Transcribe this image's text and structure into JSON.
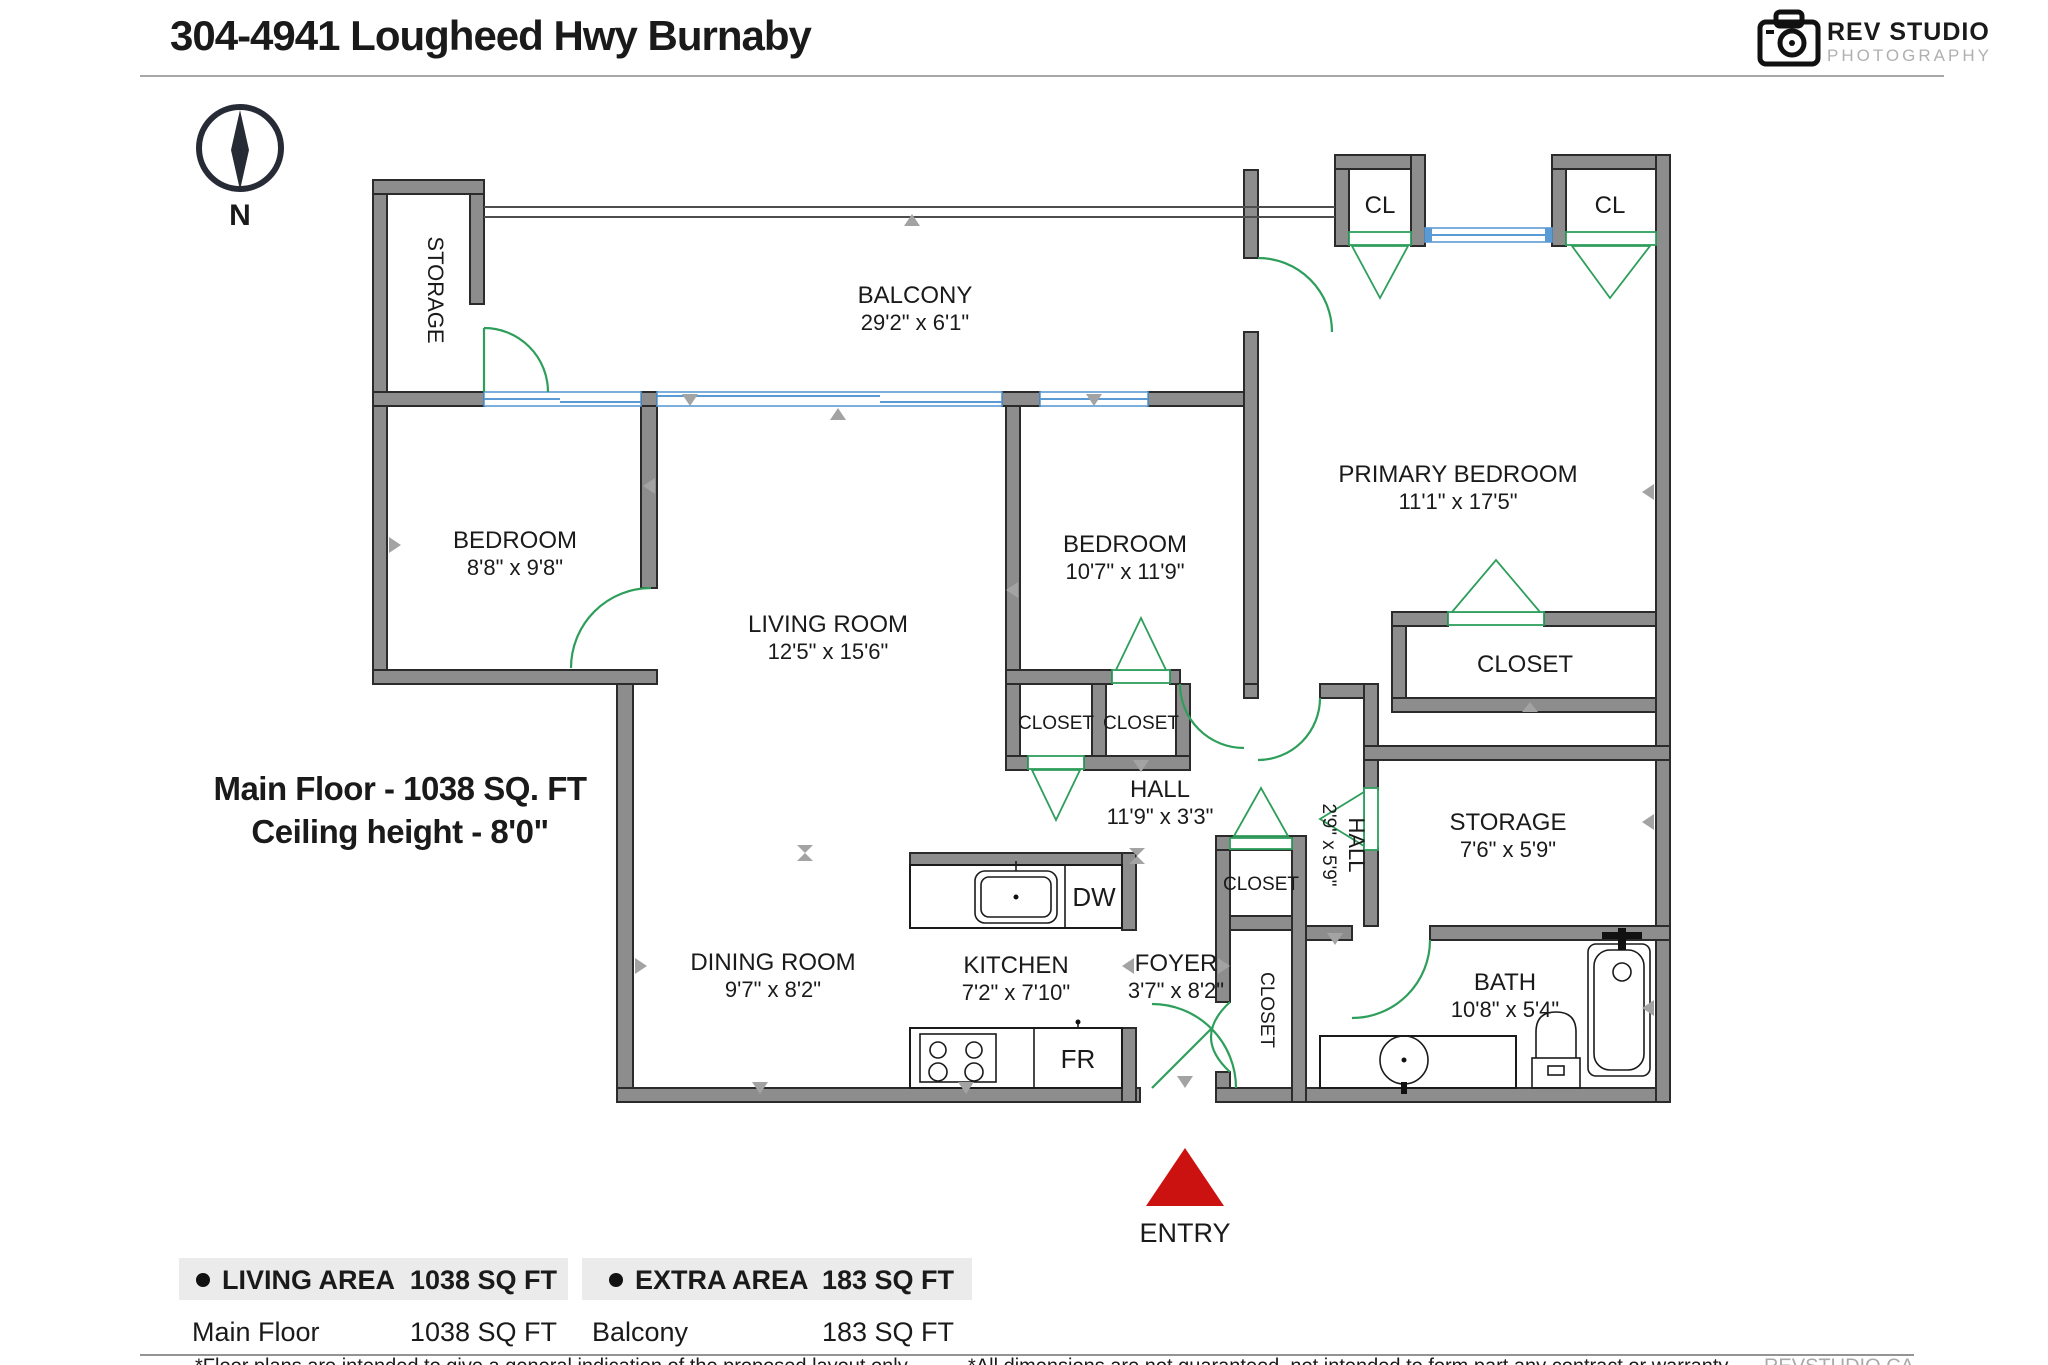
{
  "header": {
    "title": "304-4941 Lougheed Hwy Burnaby",
    "logo": {
      "name": "REV STUDIO",
      "subtitle": "PHOTOGRAPHY"
    }
  },
  "compass": {
    "label": "N"
  },
  "floor_info": {
    "line1": "Main Floor - 1038 SQ. FT",
    "line2": "Ceiling height - 8'0\""
  },
  "rooms": {
    "storage_top": {
      "name": "STORAGE"
    },
    "balcony": {
      "name": "BALCONY",
      "dims": "29'2\" x 6'1\""
    },
    "cl": {
      "name": "CL"
    },
    "bedroom1": {
      "name": "BEDROOM",
      "dims": "8'8\" x 9'8\""
    },
    "living": {
      "name": "LIVING ROOM",
      "dims": "12'5\" x 15'6\""
    },
    "bedroom2": {
      "name": "BEDROOM",
      "dims": "10'7\" x 11'9\""
    },
    "primary": {
      "name": "PRIMARY BEDROOM",
      "dims": "11'1\" x 17'5\""
    },
    "closet": {
      "name": "CLOSET"
    },
    "hall1": {
      "name": "HALL",
      "dims": "11'9\" x 3'3\""
    },
    "hall2": {
      "name": "HALL",
      "dims": "2'9\" x 5'9\""
    },
    "storage2": {
      "name": "STORAGE",
      "dims": "7'6\" x 5'9\""
    },
    "bath": {
      "name": "BATH",
      "dims": "10'8\" x 5'4\""
    },
    "kitchen": {
      "name": "KITCHEN",
      "dims": "7'2\" x 7'10\""
    },
    "dining": {
      "name": "DINING ROOM",
      "dims": "9'7\" x 8'2\""
    },
    "foyer": {
      "name": "FOYER",
      "dims": "3'7\" x 8'2\""
    }
  },
  "fixtures": {
    "dishwasher": "DW",
    "fridge": "FR"
  },
  "entry": {
    "label": "ENTRY"
  },
  "legend": {
    "living": {
      "header": "LIVING AREA",
      "total": "1038 SQ FT",
      "row_label": "Main Floor",
      "row_value": "1038 SQ FT"
    },
    "extra": {
      "header": "EXTRA AREA",
      "total": "183 SQ FT",
      "row_label": "Balcony",
      "row_value": "183 SQ FT"
    }
  },
  "footer": {
    "note1": "*Floor plans are intended to give a general indication of the proposed layout only.",
    "note2": "*All dimensions are not guaranteed, not intended to form part any contract or warranty.",
    "brand": "REVSTUDIO.CA"
  },
  "colors": {
    "wall": "#8d8d8d",
    "door": "#2e9e5b",
    "window": "#5b9bd5",
    "entry_arrow": "#cc1111",
    "legend_bg": "#ebebeb"
  }
}
